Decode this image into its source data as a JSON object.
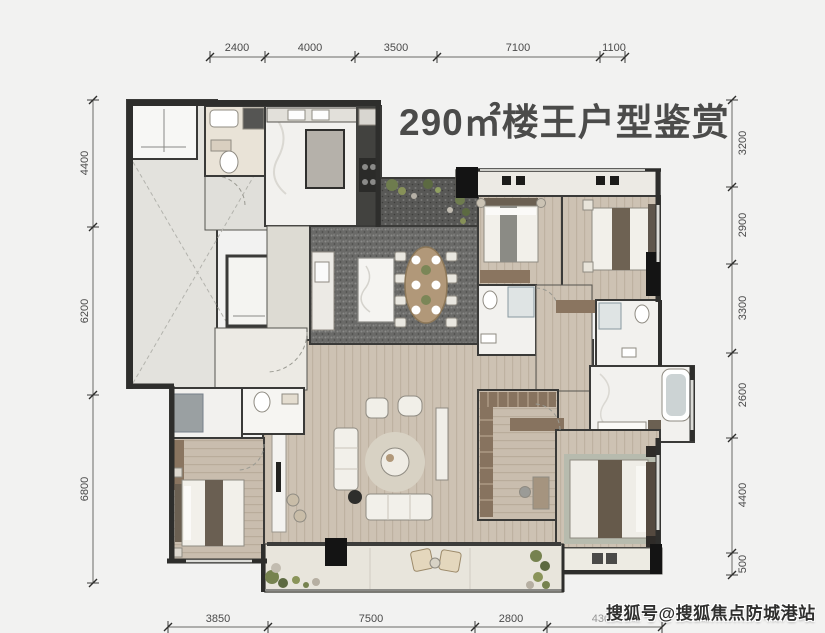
{
  "title": "290㎡楼王户型鉴赏",
  "watermark": "搜狐号@搜狐焦点防城港站",
  "dimensions": {
    "top": [
      "2400",
      "4000",
      "3500",
      "7100",
      "1100"
    ],
    "left": [
      "4400",
      "6200",
      "6800"
    ],
    "right": [
      "3200",
      "2900",
      "3300",
      "2600",
      "4400",
      "500"
    ],
    "bottom": [
      "3850",
      "7500",
      "2800",
      "4300"
    ]
  },
  "colors": {
    "background": "#f2f2f1",
    "wall": "#3a3a38",
    "wood_floor": "#cdc2b3",
    "marble_floor": "#f2f1ee",
    "dark_carpet": "#6a6a68",
    "lobby_floor": "#e3e2dd",
    "balcony_floor": "#e8e5dc",
    "dim_text": "#4a4a4a",
    "title_text": "#4b4b4a",
    "plant_green": "#76824f",
    "watermark_text": "#2f2f2e"
  }
}
